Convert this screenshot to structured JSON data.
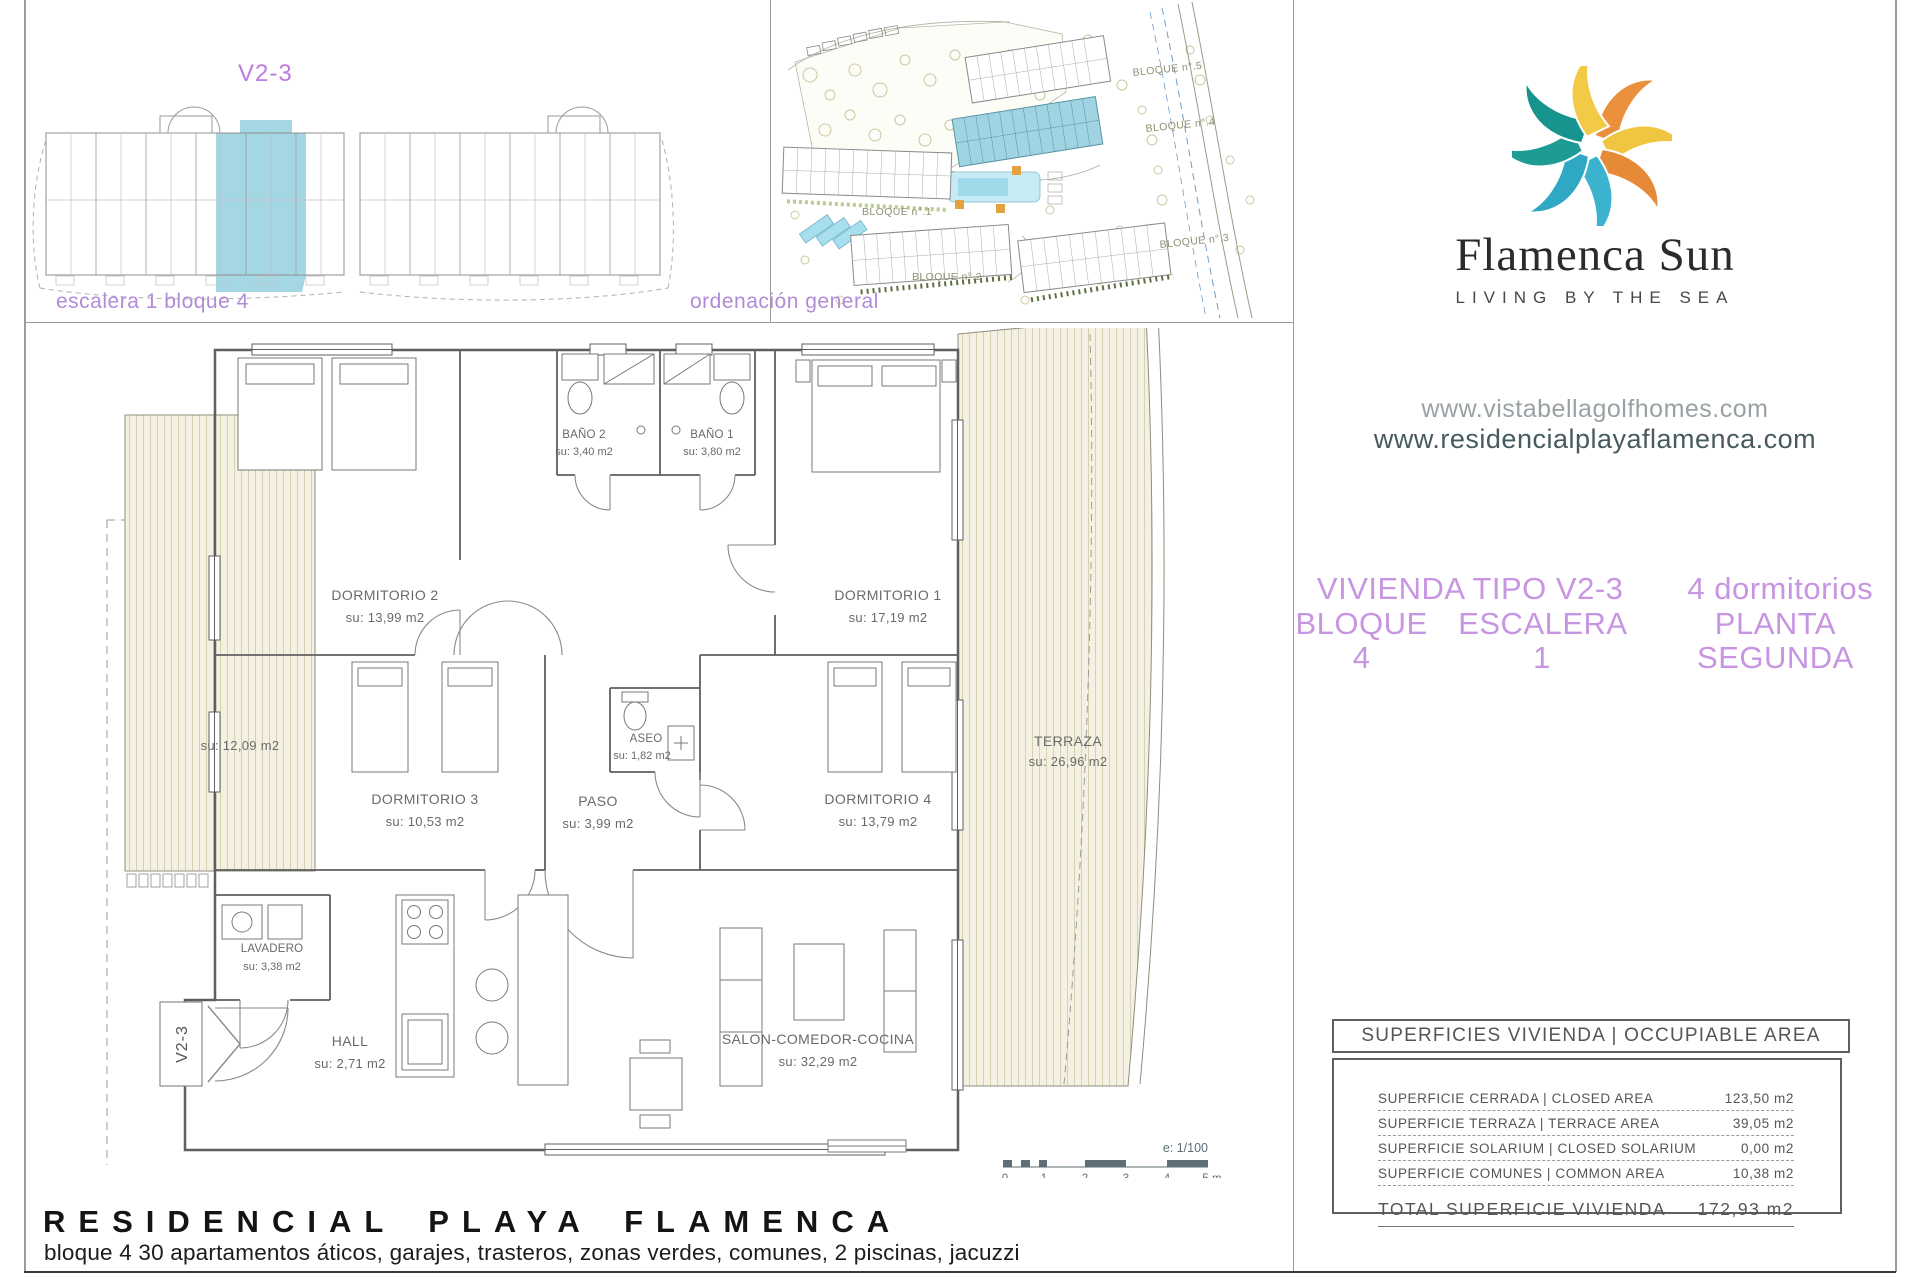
{
  "overview": {
    "title": "V2-3",
    "caption": "escalera 1 bloque 4",
    "highlight_color": "#a4d6e3"
  },
  "siteplan": {
    "caption": "ordenación general",
    "labels": {
      "b5": "BLOQUE n°.5",
      "b4": "BLOQUE n°.4",
      "b3": "BLOQUE n°.3",
      "b2": "BLOQUE n°.2",
      "b1": "BLOQUE n°.1"
    },
    "highlight_color": "#a0d4e3"
  },
  "brand": {
    "name": "Flamenca Sun",
    "tagline": "LIVING BY THE SEA",
    "website1": "www.vistabellagolfhomes.com",
    "website2": "www.residencialplayaflamenca.com",
    "logo_colors": [
      "#EA8F3B",
      "#F0C53F",
      "#E78A38",
      "#3BB3CF",
      "#2FA8C4",
      "#1D9B94",
      "#17948D",
      "#F3CA45"
    ]
  },
  "unit_heading": {
    "type": "VIVIENDA TIPO V2-3",
    "bedrooms": "4 dormitorios",
    "block": "BLOQUE 4",
    "stair": "ESCALERA 1",
    "floor": "PLANTA SEGUNDA",
    "accent_color": "#c795e2"
  },
  "floorplan": {
    "rooms": {
      "dorm2": {
        "name": "DORMITORIO 2",
        "area": "su: 13,99 m2"
      },
      "bano2": {
        "name": "BAÑO 2",
        "area": "su: 3,40 m2"
      },
      "bano1": {
        "name": "BAÑO 1",
        "area": "su: 3,80 m2"
      },
      "dorm1": {
        "name": "DORMITORIO 1",
        "area": "su: 17,19 m2"
      },
      "terraza_izq": {
        "area": "su: 12,09 m2"
      },
      "dorm3": {
        "name": "DORMITORIO 3",
        "area": "su: 10,53 m2"
      },
      "aseo": {
        "name": "ASEO",
        "area": "su: 1,82 m2"
      },
      "paso": {
        "name": "PASO",
        "area": "su: 3,99 m2"
      },
      "dorm4": {
        "name": "DORMITORIO 4",
        "area": "su: 13,79 m2"
      },
      "terraza": {
        "name": "TERRAZA",
        "area": "su: 26,96 m2"
      },
      "lavadero": {
        "name": "LAVADERO",
        "area": "su: 3,38 m2"
      },
      "hall": {
        "name": "HALL",
        "area": "su: 2,71 m2"
      },
      "salon": {
        "name": "SALON-COMEDOR-COCINA",
        "area": "su: 32,29 m2"
      }
    },
    "unit_marker": "V2-3",
    "scale_label": "e: 1/100",
    "scale_ticks": [
      "0",
      "1",
      "2",
      "3",
      "4",
      "5 m"
    ]
  },
  "areas_table": {
    "header": "SUPERFICIES VIVIENDA | OCCUPIABLE AREA",
    "rows": [
      {
        "label": "SUPERFICIE CERRADA | CLOSED AREA",
        "value": "123,50 m2"
      },
      {
        "label": "SUPERFICIE TERRAZA   | TERRACE AREA",
        "value": "39,05 m2"
      },
      {
        "label": "SUPERFICIE SOLARIUM | CLOSED SOLARIUM",
        "value": "0,00 m2"
      },
      {
        "label": "SUPERFICIE COMUNES | COMMON AREA",
        "value": "10,38 m2"
      }
    ],
    "total": {
      "label": "TOTAL SUPERFICIE VIVIENDA",
      "value": "172,93 m2"
    }
  },
  "footer": {
    "title": "RESIDENCIAL PLAYA FLAMENCA",
    "subtitle": "bloque 4 30 apartamentos áticos, garajes, trasteros, zonas verdes, comunes, 2 piscinas, jacuzzi"
  }
}
